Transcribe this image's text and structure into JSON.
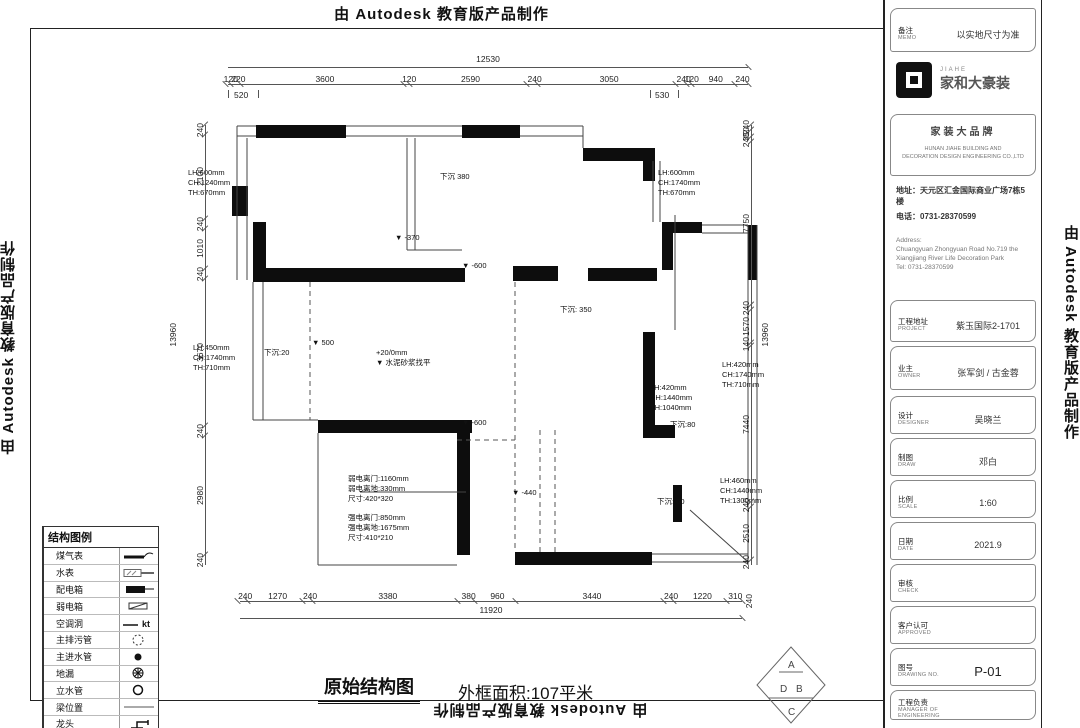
{
  "credit": {
    "text": "由 Autodesk 教育版产品制作"
  },
  "caption": {
    "title": "原始结构图",
    "area": "外框面积:107平米"
  },
  "dimensions": {
    "top": {
      "total": "12530",
      "segments": [
        "120",
        "220",
        "3600",
        "120",
        "2590",
        "240",
        "3050",
        "240",
        "120",
        "940",
        "240"
      ],
      "tier2_left": "520",
      "tier2_right": "530"
    },
    "bottom": {
      "total": "11920",
      "segments": [
        "240",
        "1270",
        "240",
        "3380",
        "380",
        "960",
        "3440",
        "240",
        "1220",
        "310"
      ],
      "corner": "240"
    },
    "left": {
      "total": "13960",
      "segments": [
        "240",
        "2100",
        "240",
        "1010",
        "240",
        "3670",
        "240",
        "2980",
        "240"
      ]
    },
    "right": {
      "total": "13960",
      "segments": [
        "240",
        "350",
        "240",
        "7750",
        "240",
        "1570",
        "140",
        "7440",
        "240",
        "2510",
        "240"
      ]
    }
  },
  "plan": {
    "annotations": [
      {
        "text": "下沉 380",
        "x": 440,
        "y": 172
      },
      {
        "text": "LH:600mm\nCH:1240mm\nTH:670mm",
        "x": 188,
        "y": 168
      },
      {
        "text": "LH:600mm\nCH:1740mm\nTH:670mm",
        "x": 658,
        "y": 168
      },
      {
        "text": "▼ -370",
        "x": 395,
        "y": 233
      },
      {
        "text": "▼ -600",
        "x": 462,
        "y": 261
      },
      {
        "text": "下沉: 350",
        "x": 560,
        "y": 305
      },
      {
        "text": "LH:450mm\nCH:1740mm\nTH:710mm",
        "x": 193,
        "y": 343
      },
      {
        "text": "下沉:20",
        "x": 264,
        "y": 348
      },
      {
        "text": "▼ 500",
        "x": 312,
        "y": 338
      },
      {
        "text": "+20/0mm\n▼ 水泥砂浆找平",
        "x": 376,
        "y": 348
      },
      {
        "text": "LH:420mm\nCH:1440mm\nTH:1040mm",
        "x": 650,
        "y": 383
      },
      {
        "text": "LH:420mm\nCH:1740mm\nTH:710mm",
        "x": 722,
        "y": 360
      },
      {
        "text": "下沉:80",
        "x": 670,
        "y": 420
      },
      {
        "text": "▼ -600",
        "x": 462,
        "y": 418
      },
      {
        "text": "弱电离门:1160mm\n弱电离地:330mm\n尺寸:420*320",
        "x": 348,
        "y": 474
      },
      {
        "text": "强电离门:850mm\n强电离地:1675mm\n尺寸:410*210",
        "x": 348,
        "y": 513
      },
      {
        "text": "▼ -440",
        "x": 512,
        "y": 488
      },
      {
        "text": "下沉: 60",
        "x": 657,
        "y": 497
      },
      {
        "text": "LH:460mm\nCH:1440mm\nTH:1300mm",
        "x": 720,
        "y": 476
      }
    ]
  },
  "legend": {
    "title": "结构图例",
    "items": [
      {
        "label": "煤气表",
        "sym": "gas"
      },
      {
        "label": "水表",
        "sym": "watermeter"
      },
      {
        "label": "配电箱",
        "sym": "distbox"
      },
      {
        "label": "弱电箱",
        "sym": "weakbox"
      },
      {
        "label": "空调洞",
        "sym": "achole",
        "sym_text": "kt"
      },
      {
        "label": "主排污管",
        "sym": "sewage"
      },
      {
        "label": "主进水管",
        "sym": "inlet"
      },
      {
        "label": "地漏",
        "sym": "drain"
      },
      {
        "label": "立水管",
        "sym": "standpipe"
      },
      {
        "label": "梁位置",
        "sym": "beam"
      },
      {
        "label": "龙头",
        "sym": "faucet"
      }
    ]
  },
  "title_block": {
    "memo": {
      "label": "备注",
      "en": "MEMO",
      "value": "以实地尺寸为准"
    },
    "brand": {
      "logo_small": "JIAHE",
      "logo_main": "家和大豪装",
      "slogan": "家装大品牌",
      "en1": "HUNAN JIAHE BUILDING AND",
      "en2": "DECORATION DESIGN ENGINEERING CO.,LTD"
    },
    "contact": {
      "addr": "地址：天元区汇金国际商业广场7栋5楼",
      "tel": "电话：0731-28370599"
    },
    "contact_en": {
      "l1": "Address:",
      "l2": "Chuangyuan Zhongyuan Road No.719 the",
      "l3": "Xiangjiang River Life Decoration Park",
      "l4": "Tel: 0731-28370599"
    },
    "fields": [
      {
        "label": "工程地址",
        "en": "PROJECT",
        "value": "紫玉国际2-1701"
      },
      {
        "label": "业主",
        "en": "OWNER",
        "value": "张军剑 / 古金蓉"
      },
      {
        "label": "设计",
        "en": "DESIGNER",
        "value": "吴晓兰"
      },
      {
        "label": "制图",
        "en": "DRAW",
        "value": "邓白"
      },
      {
        "label": "比例",
        "en": "SCALE",
        "value": "1:60"
      },
      {
        "label": "日期",
        "en": "DATE",
        "value": "2021.9"
      },
      {
        "label": "审核",
        "en": "CHECK",
        "value": ""
      },
      {
        "label": "客户认可",
        "en": "APPROVED",
        "value": ""
      },
      {
        "label": "图号",
        "en": "DRAWING NO.",
        "value": "P-01",
        "big": true
      },
      {
        "label": "工程负责",
        "en": "MANAGER OF ENGINEERING",
        "value": ""
      }
    ]
  },
  "compass": {
    "letters": [
      "A",
      "D",
      "B",
      "C"
    ]
  }
}
